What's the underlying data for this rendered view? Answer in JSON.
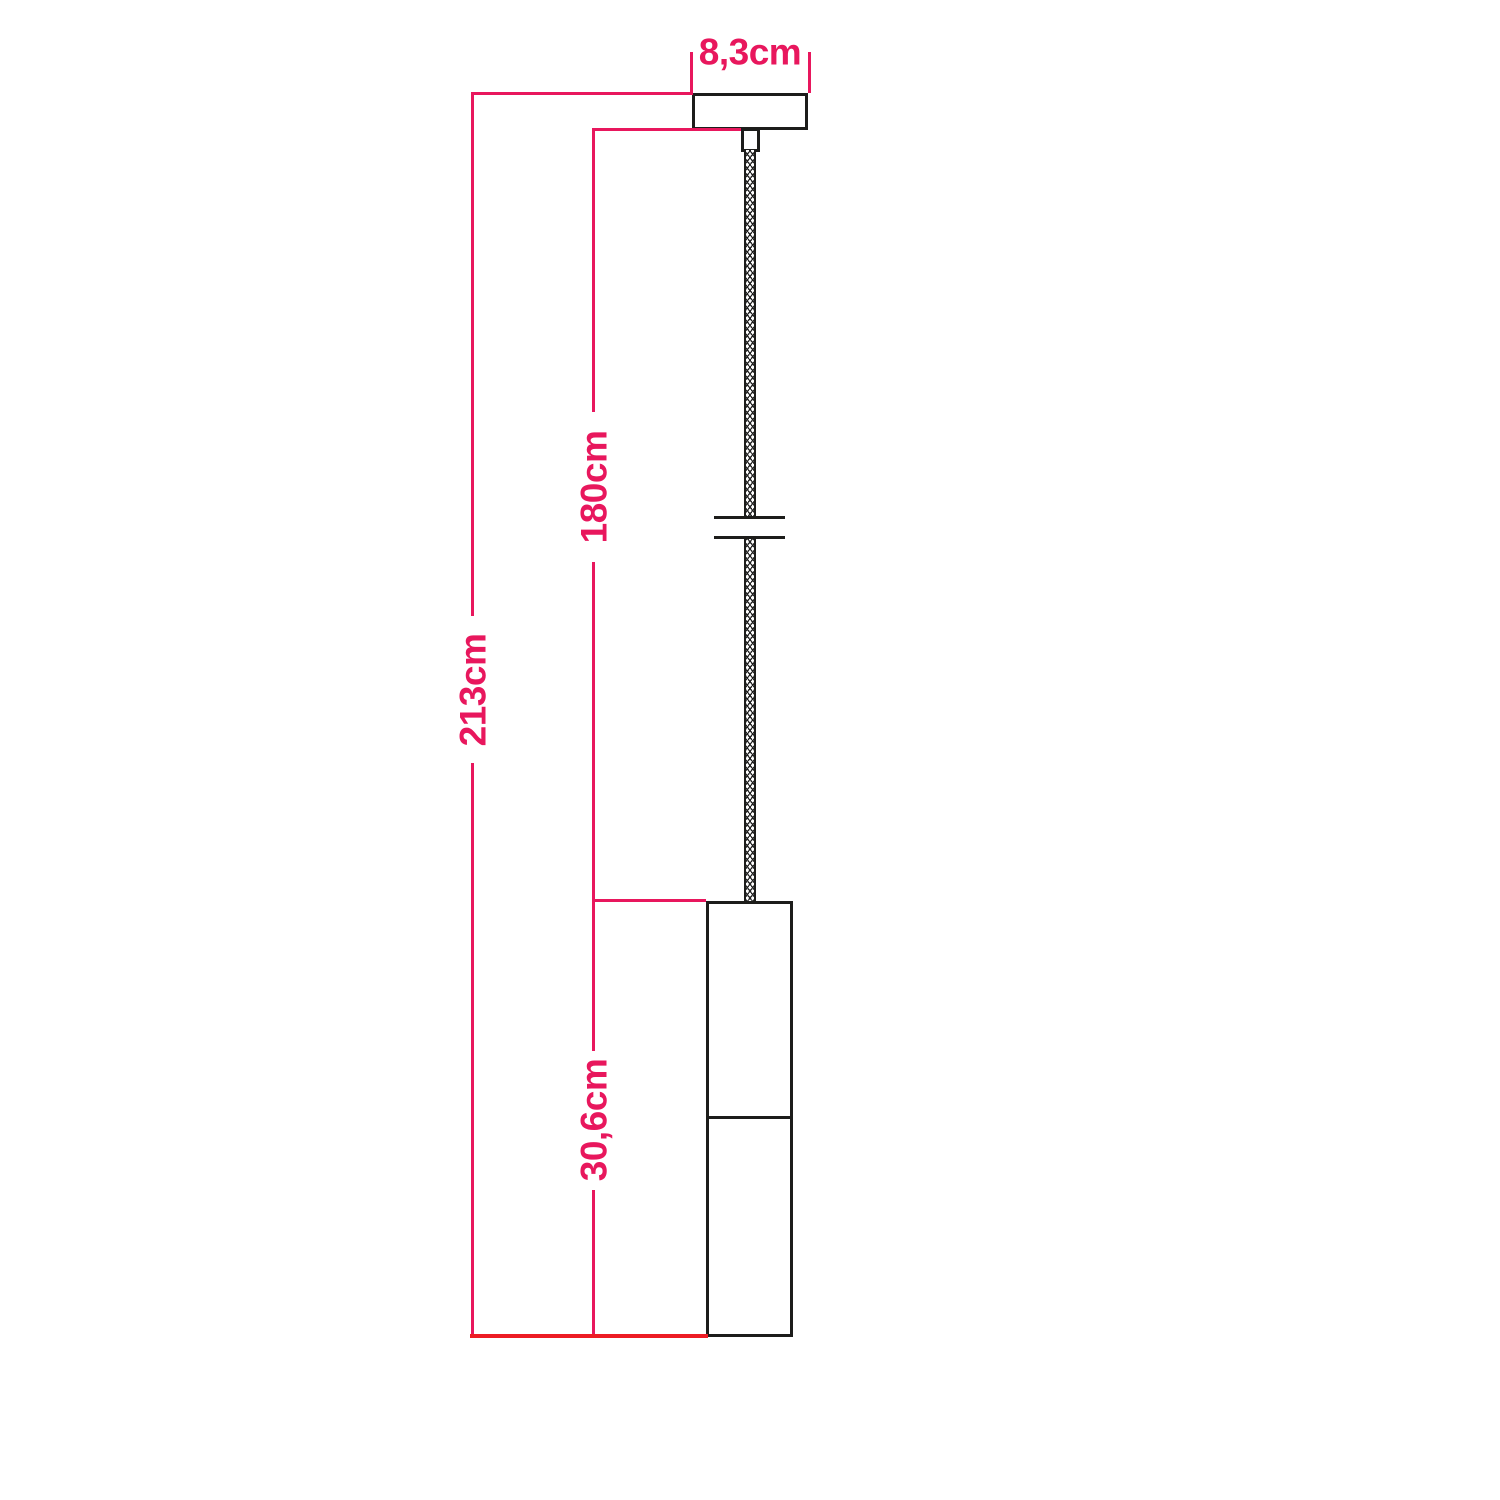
{
  "diagram": {
    "title": "pendant-lamp-dimension-drawing",
    "labels": {
      "canopy_width": "8,3cm",
      "cable_drop": "180cm",
      "total_drop": "213cm",
      "shade_height": "30,6cm"
    },
    "colors": {
      "dimension_pink": "#e8175d",
      "baseline_red": "#ed1c24",
      "outline_black": "#1d1d1b",
      "background": "#ffffff"
    }
  }
}
